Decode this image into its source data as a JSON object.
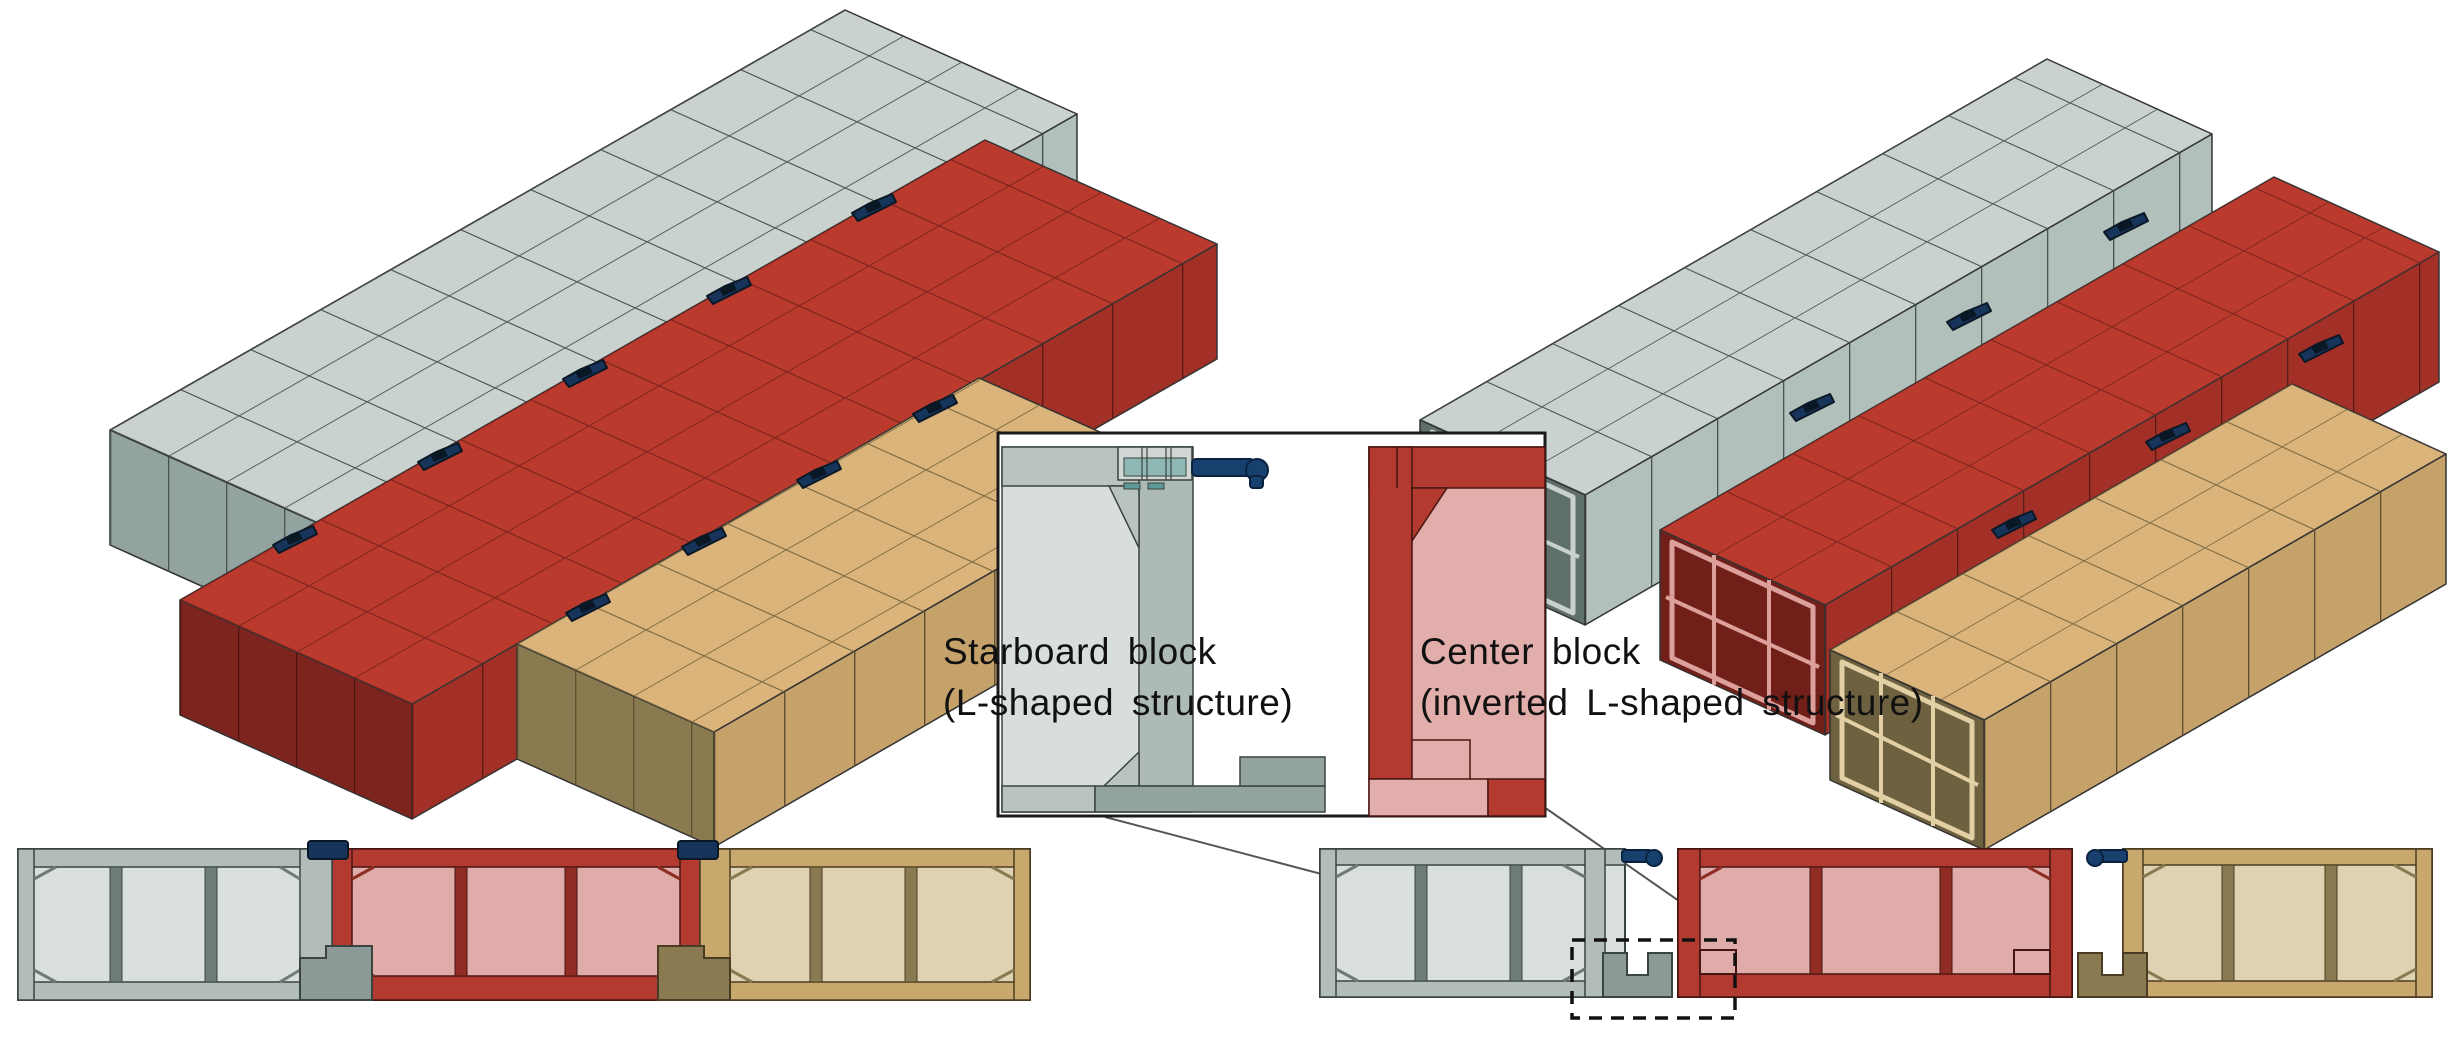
{
  "figure": {
    "inset": {
      "starboard_line1": "Starboard block",
      "starboard_line2": "(L-shaped structure)",
      "center_line1": "Center block",
      "center_line2": "(inverted L-shaped structure)"
    },
    "colors": {
      "starboard_block_top": "#c9d2cf",
      "center_block_top": "#bb3a2e",
      "port_block_top": "#dab47a",
      "connector_clamp": "#17355a",
      "guide_pin": "#17406f",
      "background": "#ffffff",
      "outline": "#333333"
    },
    "icons": {
      "clamp": "clamp-icon",
      "pin": "pin-icon"
    }
  }
}
